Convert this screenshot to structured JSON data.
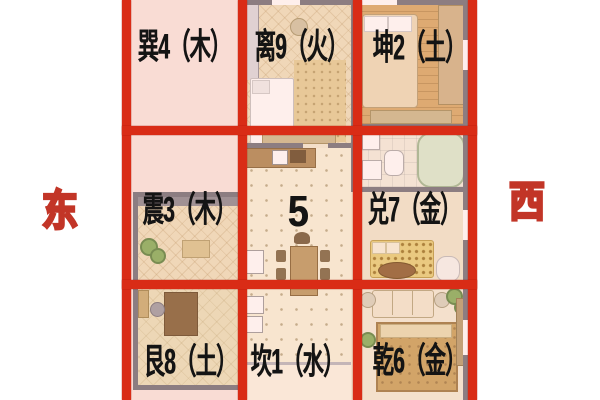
{
  "compass": {
    "east": "东",
    "west": "西"
  },
  "grid": {
    "cells": [
      {
        "id": "xun-4",
        "label": "巽4（木）"
      },
      {
        "id": "li-9",
        "label": "离9（火）"
      },
      {
        "id": "kun-2",
        "label": "坤2（土）"
      },
      {
        "id": "zhen-3",
        "label": "震3（木）"
      },
      {
        "id": "center-5",
        "label": "5"
      },
      {
        "id": "dui-7",
        "label": "兑7（金）"
      },
      {
        "id": "gen-8",
        "label": "艮8（土）"
      },
      {
        "id": "kan-1",
        "label": "坎1（水）"
      },
      {
        "id": "qian-6",
        "label": "乾6（金）"
      }
    ]
  },
  "colors": {
    "grid_line": "#d92c16",
    "outside_tint": "#f9e7e1",
    "compass_red": "#c23527",
    "label_color": "#141414",
    "wall_gray": "#6e6e76"
  }
}
